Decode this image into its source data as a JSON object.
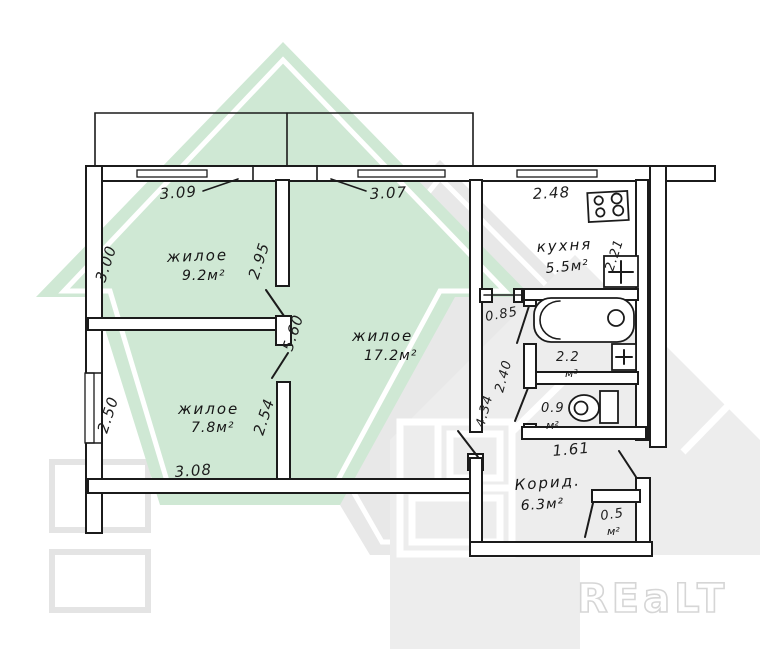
{
  "watermarks": {
    "brand_text": "REaLT",
    "green_color": "#cfe8d4",
    "gray_color": "#e8e8e8"
  },
  "rooms": {
    "room_9": {
      "label": "жилое",
      "area": "9.2м²"
    },
    "room_17": {
      "label": "жилое",
      "area": "17.2м²"
    },
    "room_7": {
      "label": "жилое",
      "area": "7.8м²"
    },
    "kitchen": {
      "label": "кухня",
      "area": "5.5м²"
    },
    "bathroom": {
      "area": "2.2",
      "unit": "м²"
    },
    "toilet": {
      "area": "0.9",
      "unit": "м²"
    },
    "corridor": {
      "label": "Корид.",
      "area": "6.3м²"
    },
    "closet": {
      "area": "0.5",
      "unit": "м²"
    }
  },
  "dimensions": {
    "room9_window": "3.09",
    "room17_window": "3.07",
    "kitchen_window": "2.48",
    "room9_depth": "3.00",
    "room9_wall": "2.95",
    "room17_depth": "5.60",
    "room7_depth": "2.50",
    "room7_wall": "2.54",
    "room7_width": "3.08",
    "passage_width": "0.85",
    "passage_mid": "2.40",
    "passage_length": "4.34",
    "kitchen_depth": "2.21",
    "toilet_width": "1.61"
  }
}
